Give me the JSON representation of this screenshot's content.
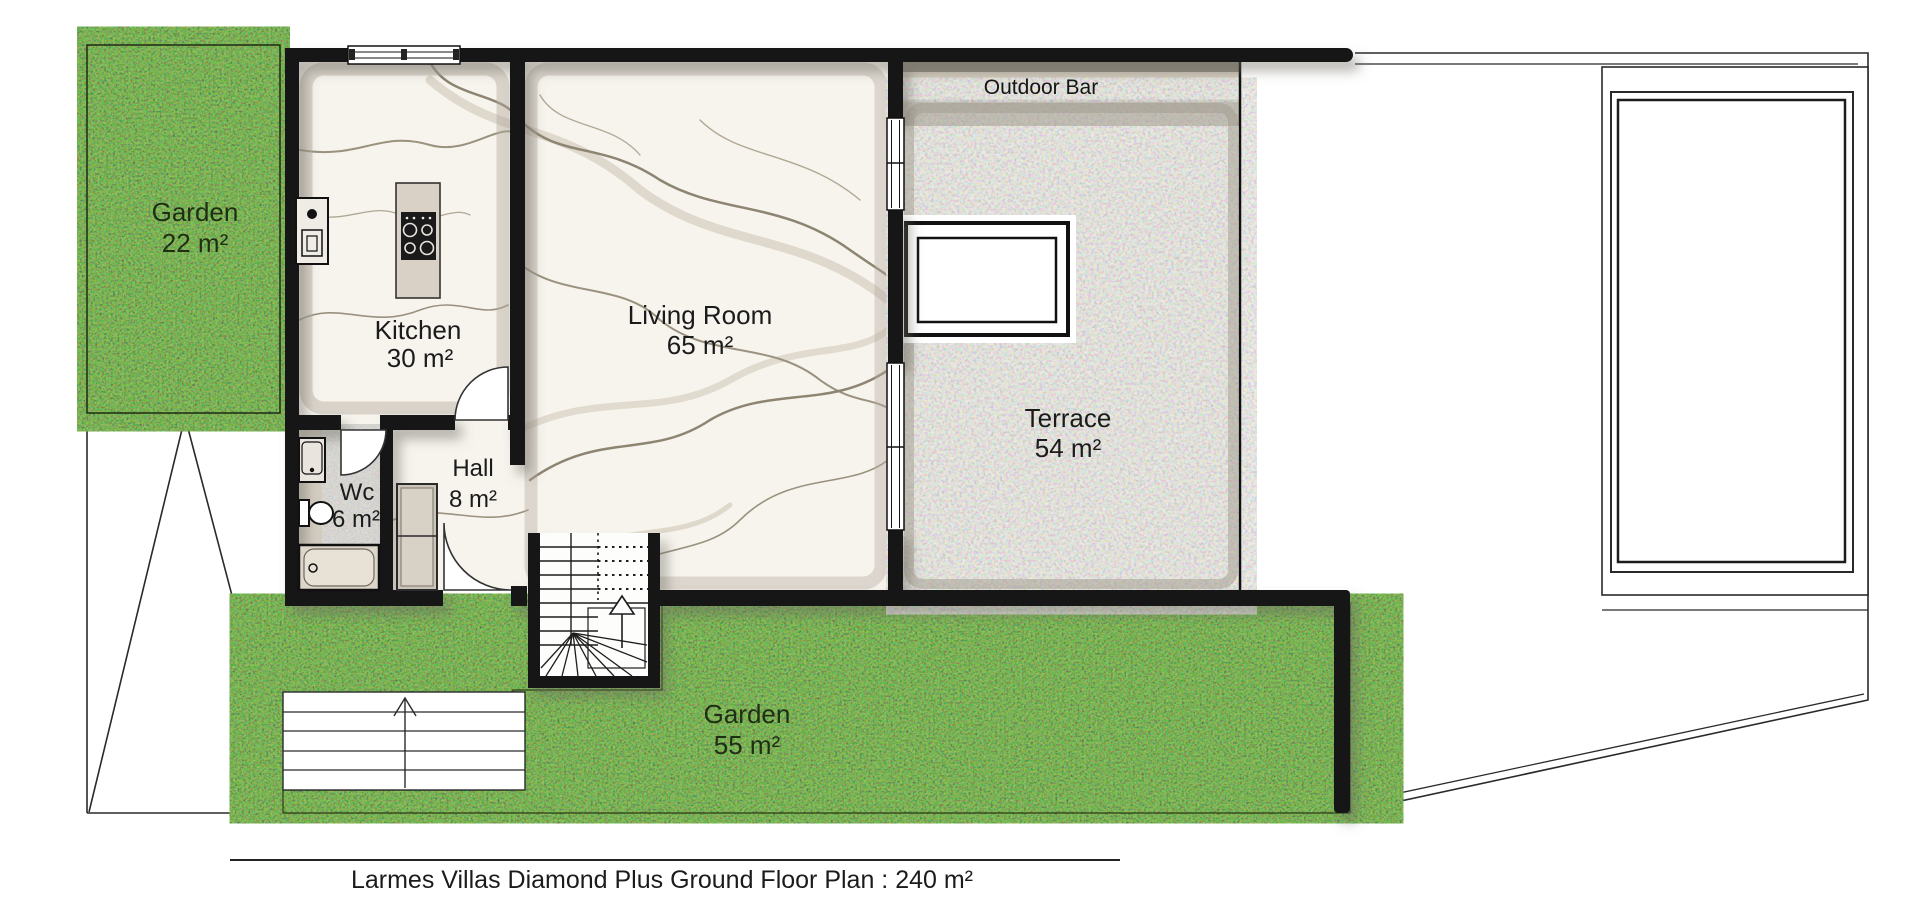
{
  "title": "Larmes Villas Diamond Plus Ground Floor Plan : 240 m²",
  "labels": {
    "garden_left": {
      "name": "Garden",
      "area": "22 m²"
    },
    "kitchen": {
      "name": "Kitchen",
      "area": "30 m²"
    },
    "living_room": {
      "name": "Living Room",
      "area": "65 m²"
    },
    "hall": {
      "name": "Hall",
      "area": "8 m²"
    },
    "wc": {
      "name": "Wc",
      "area": "6 m²"
    },
    "terrace": {
      "name": "Terrace",
      "area": "54 m²"
    },
    "garden_bottom": {
      "name": "Garden",
      "area": "55 m²"
    },
    "outdoor_bar": {
      "name": "Outdoor Bar"
    }
  },
  "colors": {
    "wall": "#141414",
    "line": "#2a2a2a",
    "grass_base": "#3f7a1d",
    "concrete_base": "#d7d2c6",
    "marble_base": "#f7f4ee",
    "bar_counter": "#cfc8bb",
    "furniture": "#d9d1c5"
  }
}
